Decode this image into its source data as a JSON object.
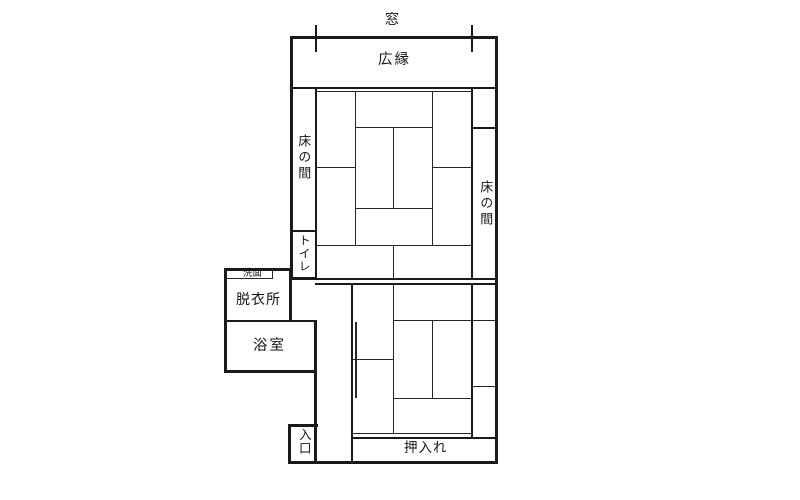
{
  "plan": {
    "labels": {
      "window": "窓",
      "veranda": "広縁",
      "tokonoma_left": "床の間",
      "tokonoma_right": "床の間",
      "toilet": "トイレ",
      "washbasin": "洗面",
      "dressing_room": "脱衣所",
      "bathroom": "浴室",
      "entrance": "入口",
      "closet": "押入れ"
    },
    "colors": {
      "line": "#1a1a1a",
      "background": "#ffffff"
    }
  }
}
